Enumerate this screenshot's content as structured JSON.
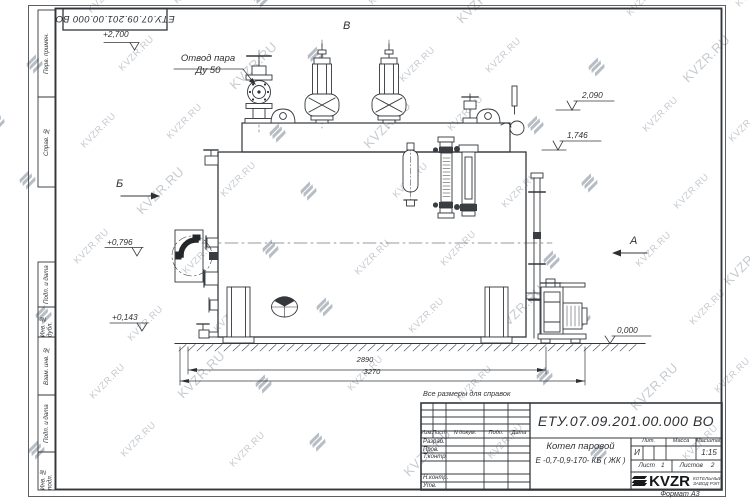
{
  "watermark": {
    "text": "KVZR.RU"
  },
  "stamp": {
    "doc_number_rotated": "ЕТУ.07.09.201.00.000  ВО"
  },
  "drawing_labels": {
    "elev_2700": "+2,700",
    "steam_outlet_1": "Отвод пара",
    "steam_outlet_2": "Ду 50",
    "view_v": "В",
    "view_b": "Б",
    "view_a": "А",
    "elev_2090": "2,090",
    "elev_1746": "1,746",
    "elev_0796": "+0,796",
    "elev_0143": "+0,143",
    "elev_0000": "0,000",
    "dim_2890": "2890",
    "dim_3270": "3270",
    "note_reference": "Все размеры для справок"
  },
  "frame_left": {
    "cells": [
      {
        "label": "Перв. примен."
      },
      {
        "label": "Справ. №"
      },
      {
        "label": "Подп. и дата"
      },
      {
        "label": "Инв. № дубл."
      },
      {
        "label": "Взам. инв. №"
      },
      {
        "label": "Подп. и дата"
      },
      {
        "label": "Инв. № подл."
      }
    ]
  },
  "title_block": {
    "doc_number": "ЕТУ.07.09.201.00.000  ВО",
    "product_title": "Котел паровой",
    "product_model": "Е -0,7-0,9-170- КБ ( ЖК )",
    "cols": {
      "izm": "Изм.",
      "list": "Лист",
      "docnum": "N докум.",
      "podp": "Подп.",
      "data": "Дата"
    },
    "roles": {
      "razrab": "Разраб.",
      "prov": "Пров.",
      "tkontr": "Т.контр.",
      "nkontr": "Н.контр.",
      "utv": "Утв."
    },
    "lit_header": "Лит.",
    "mass_header": "Масса",
    "scale_header": "Масштаб",
    "lit_value": "И",
    "scale_value": "1:15",
    "sheet_label": "Лист",
    "sheet_value": "1",
    "sheets_label": "Листов",
    "sheets_value": "2",
    "logo_text": "KVZR",
    "logo_sub_1": "КОТЕЛЬНЫЙ",
    "logo_sub_2": "ЗАВОД РЭП",
    "format_note": "Формат А3"
  }
}
